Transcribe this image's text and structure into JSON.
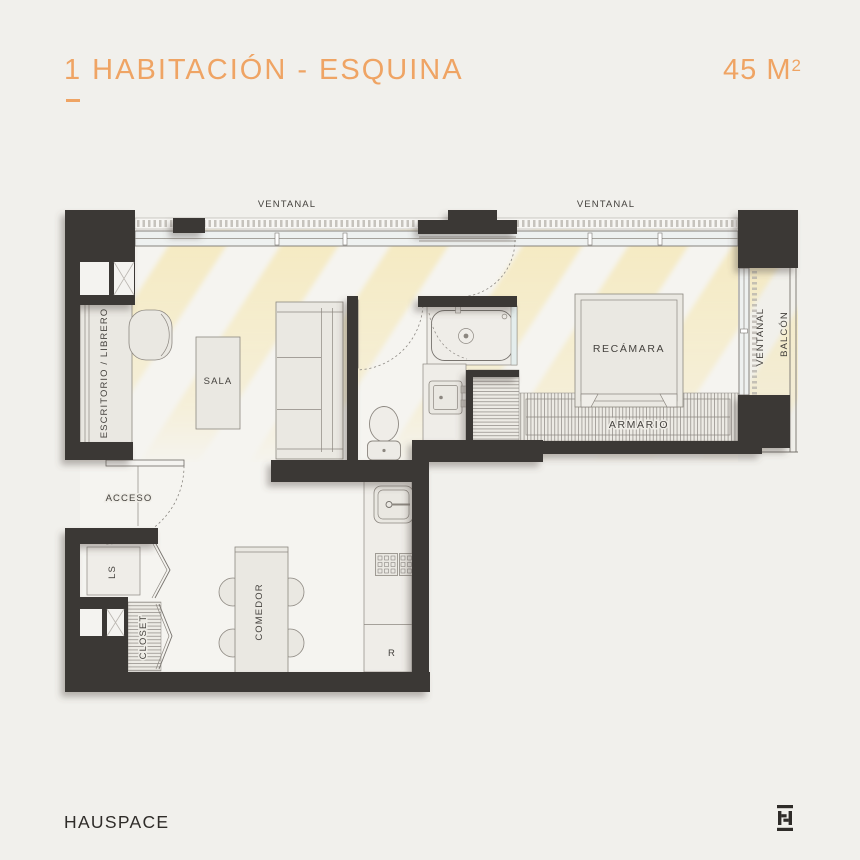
{
  "header": {
    "title": "1 HABITACIÓN - ESQUINA",
    "area_value": "45 M",
    "area_superscript": "2"
  },
  "plan": {
    "labels": {
      "ventanal_top_left": "VENTANAL",
      "ventanal_top_right": "VENTANAL",
      "ventanal_side": "VENTANAL",
      "balcon": "BALCÓN",
      "escritorio": "ESCRITORIO / LIBRERO",
      "sala": "SALA",
      "acceso": "ACCESO",
      "ls": "LS",
      "closet": "CLOSET",
      "comedor": "COMEDOR",
      "recamara": "RECÁMARA",
      "armario": "ARMARIO",
      "refrigerador": "R"
    }
  },
  "footer": {
    "brand": "HAUSPACE"
  },
  "colors": {
    "accent": "#EFA464",
    "wall": "#3B3835",
    "label": "#45423E",
    "sunlight": "#F5E9BC",
    "bg": "#F1F0EC"
  }
}
